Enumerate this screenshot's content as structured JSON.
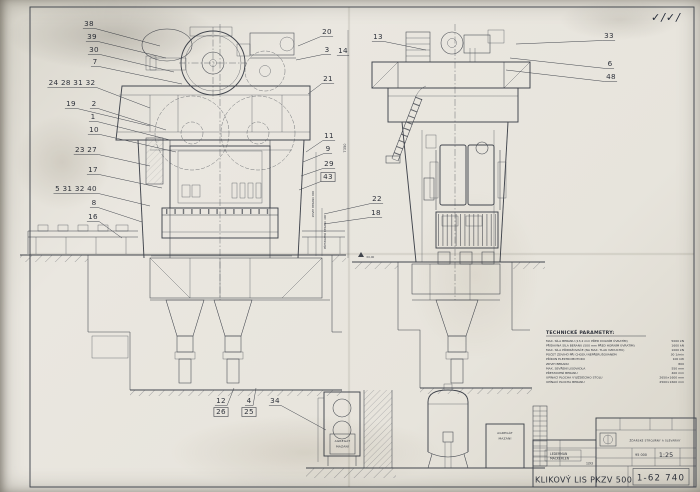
{
  "page": {
    "checkmarks": "✓/✓/"
  },
  "drawing": {
    "callouts": [
      {
        "t": "38",
        "x": 89,
        "y": 26,
        "ex": 160,
        "ey": 46
      },
      {
        "t": "39",
        "x": 92,
        "y": 39,
        "ex": 166,
        "ey": 58
      },
      {
        "t": "30",
        "x": 94,
        "y": 52,
        "ex": 174,
        "ey": 72
      },
      {
        "t": "7",
        "x": 95,
        "y": 64,
        "ex": 182,
        "ey": 84
      },
      {
        "t": "24 28 31 32",
        "x": 72,
        "y": 85,
        "ex": 150,
        "ey": 108
      },
      {
        "t": "19",
        "x": 71,
        "y": 106,
        "ex": 150,
        "ey": 126
      },
      {
        "t": "2",
        "x": 94,
        "y": 106,
        "ex": 166,
        "ey": 130
      },
      {
        "t": "1",
        "x": 93,
        "y": 119,
        "ex": 170,
        "ey": 140
      },
      {
        "t": "10",
        "x": 94,
        "y": 132,
        "ex": 176,
        "ey": 152
      },
      {
        "t": "23 27",
        "x": 86,
        "y": 152,
        "ex": 150,
        "ey": 166
      },
      {
        "t": "17",
        "x": 93,
        "y": 172,
        "ex": 162,
        "ey": 188
      },
      {
        "t": "5 31 32 40",
        "x": 76,
        "y": 191,
        "ex": 150,
        "ey": 206
      },
      {
        "t": "8",
        "x": 94,
        "y": 205,
        "ex": 142,
        "ey": 222
      },
      {
        "t": "16",
        "x": 93,
        "y": 219,
        "ex": 122,
        "ey": 238
      },
      {
        "t": "20",
        "x": 327,
        "y": 34,
        "ex": 298,
        "ey": 46
      },
      {
        "t": "3",
        "x": 327,
        "y": 52,
        "ex": 296,
        "ey": 60
      },
      {
        "t": "14",
        "x": 343,
        "y": 53
      },
      {
        "t": "21",
        "x": 328,
        "y": 81,
        "ex": 308,
        "ey": 94
      },
      {
        "t": "11",
        "x": 329,
        "y": 138,
        "ex": 306,
        "ey": 152
      },
      {
        "t": "9",
        "x": 328,
        "y": 151,
        "ex": 303,
        "ey": 162
      },
      {
        "t": "29",
        "x": 329,
        "y": 166,
        "ex": 301,
        "ey": 176
      },
      {
        "t": "43",
        "x": 328,
        "y": 179,
        "ex": 299,
        "ey": 190,
        "box": true
      },
      {
        "t": "22",
        "x": 377,
        "y": 201,
        "ex": 324,
        "ey": 214
      },
      {
        "t": "18",
        "x": 376,
        "y": 215,
        "ex": 324,
        "ey": 224
      },
      {
        "t": "13",
        "x": 378,
        "y": 39,
        "ex": 426,
        "ey": 50
      },
      {
        "t": "33",
        "x": 609,
        "y": 38,
        "ex": 516,
        "ey": 44
      },
      {
        "t": "6",
        "x": 610,
        "y": 66,
        "ex": 510,
        "ey": 58
      },
      {
        "t": "48",
        "x": 611,
        "y": 79,
        "ex": 506,
        "ey": 70
      },
      {
        "t": "12",
        "x": 221,
        "y": 403,
        "ex": 234,
        "ey": 388
      },
      {
        "t": "26",
        "x": 221,
        "y": 414,
        "box": true
      },
      {
        "t": "4",
        "x": 249,
        "y": 403,
        "ex": 256,
        "ey": 388
      },
      {
        "t": "25",
        "x": 249,
        "y": 414,
        "box": true
      },
      {
        "t": "34",
        "x": 275,
        "y": 403,
        "ex": 326,
        "ey": 430
      }
    ],
    "dims": {
      "height_overall": "7350",
      "stroke": "ZDVIH BERANU 800",
      "adjust": "PŘESTAVENÍ BERANU 400",
      "ground_level": "±0,00"
    },
    "labels": {
      "agregat_line1": "AGREGÁT",
      "agregat_line2": "MAZÁNÍ"
    }
  },
  "tech_params": {
    "heading": "TECHNICKÉ PARAMETRY:",
    "rows": [
      {
        "label": "MAX. SÍLA BERANU (13,2 mm PŘED DOLNÍM ÚVRATÍM)",
        "value": "5000 kN"
      },
      {
        "label": "PŘÍDAVNÁ SÍLA BERANU (500 mm PŘED HORNÍM ÚVRATÍM)",
        "value": "1600 kN"
      },
      {
        "label": "MAX. SÍLA PŘIDRŽOVAČE (NA MAX. TLAK VZDUCHU)",
        "value": "1000 kN"
      },
      {
        "label": "POČET ZDVIHŮ PŘI CHODU NEPŘERUŠOVANÉM",
        "value": "30 1/min"
      },
      {
        "label": "PŘÍKON ELEKTROMOTORU",
        "value": "100 kW"
      },
      {
        "label": "ZDVIH BERANU",
        "value": "800"
      },
      {
        "label": "MAX. SEVŘENÍ LISOVADLA",
        "value": "550 mm"
      },
      {
        "label": "PŘESTAVENÍ BERANU",
        "value": "400 mm"
      },
      {
        "label": "UPÍNACÍ PLOCHA VYJÍŽDĚCÍHO STOLU",
        "value": "2650×1600 mm"
      },
      {
        "label": "UPÍNACÍ PLOCHA BERANU",
        "value": "2500×1600 mm"
      }
    ]
  },
  "title_block": {
    "title": "KLIKOVÝ LIS PKZV 500",
    "drawing_number": "1-62 740",
    "scale": "1:25",
    "weight_kg": "95 000",
    "company": "ŽĎÁRSKÉ STROJÍRNY A SLÉVÁRNY",
    "designer": "LEDERMAN",
    "checker": "MACKERLEN",
    "date": "1/93"
  }
}
